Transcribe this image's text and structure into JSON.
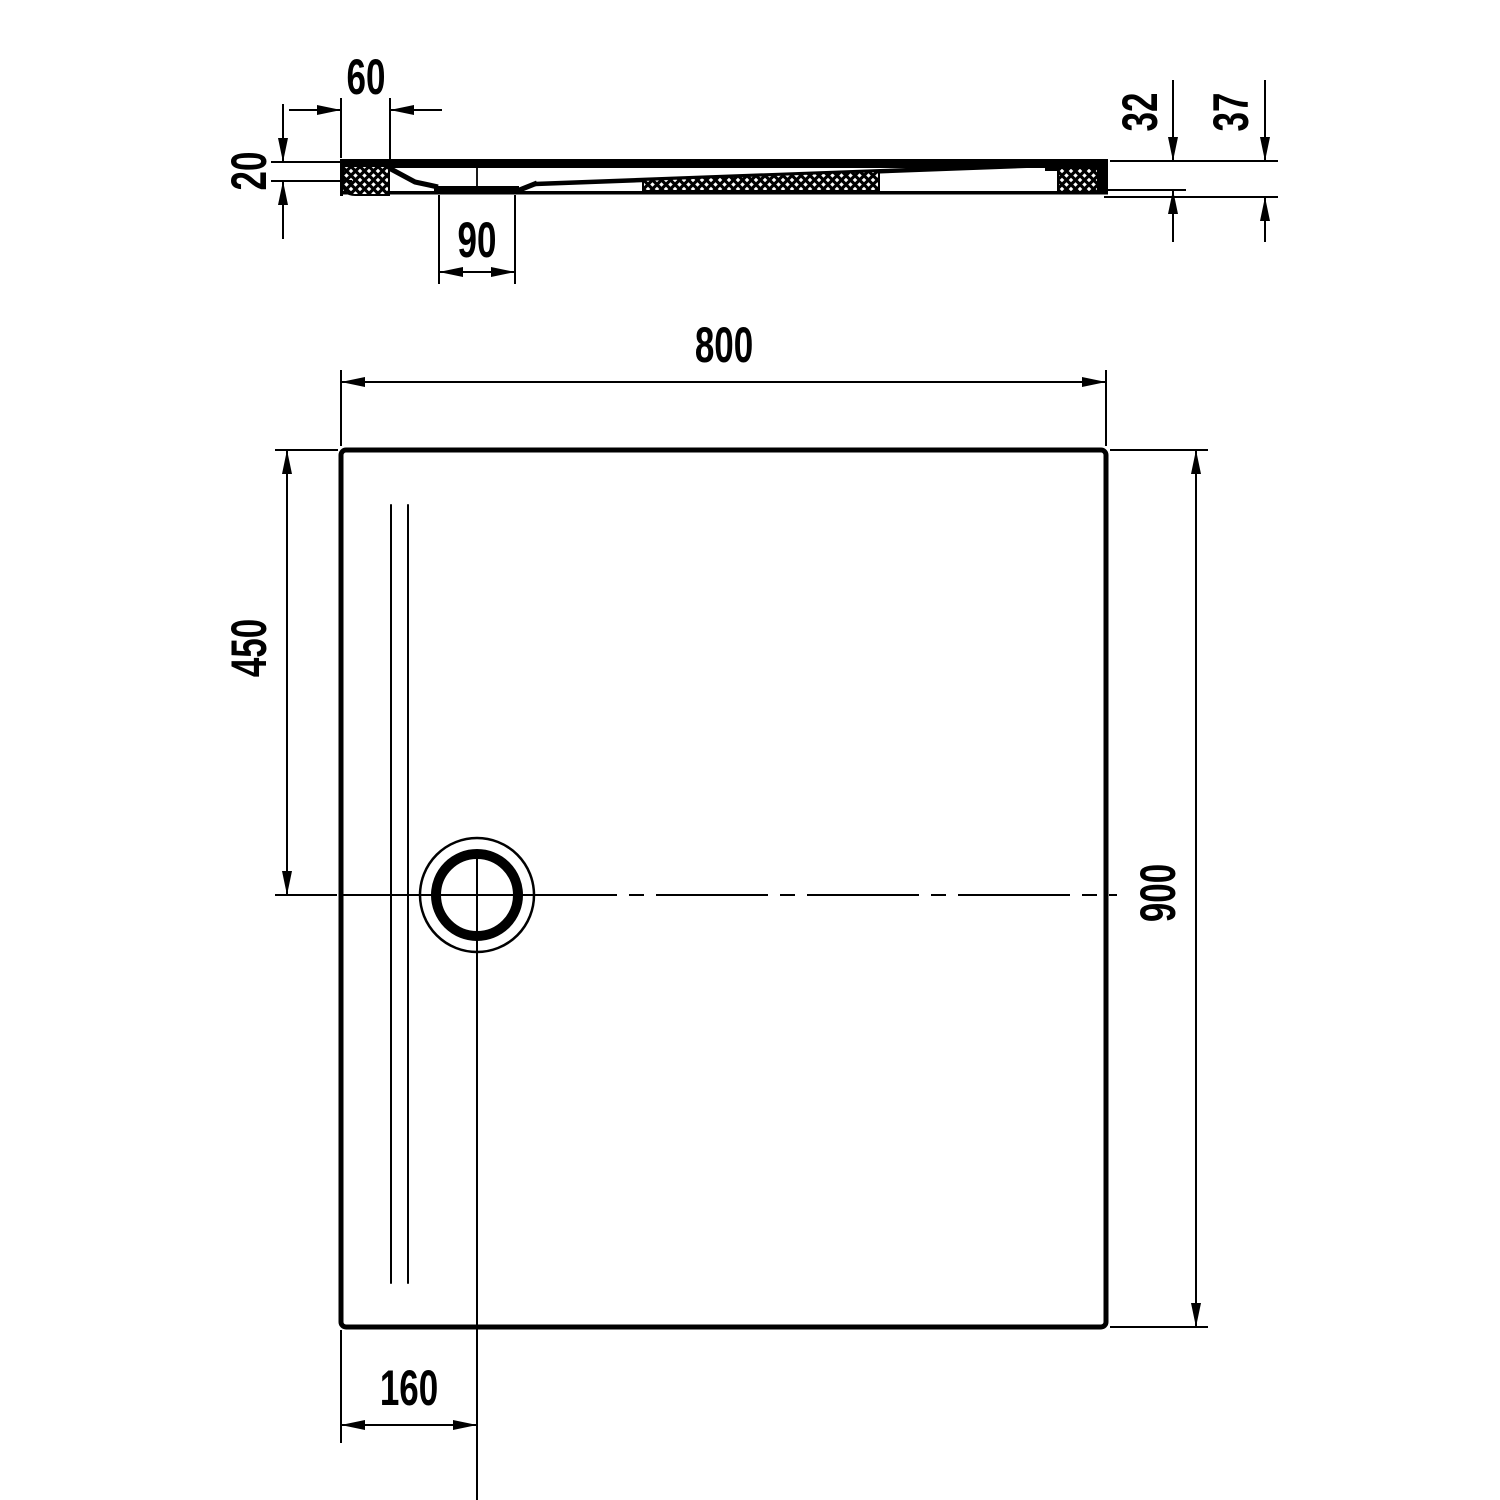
{
  "drawing": {
    "type": "technical-dimension-drawing",
    "subject": "rectangular shower tray with offset drain - section view above plan view",
    "line_color": "#000000",
    "background_color": "#ffffff",
    "section_view": {
      "dimensions": {
        "rim_to_drain_edge": "60",
        "left_edge_depth": "20",
        "drain_recess_width": "90",
        "body_height": "32",
        "overall_height": "37"
      }
    },
    "plan_view": {
      "dimensions": {
        "overall_width": "800",
        "drain_center_from_top": "450",
        "overall_depth": "900",
        "drain_center_from_left": "160"
      }
    }
  }
}
